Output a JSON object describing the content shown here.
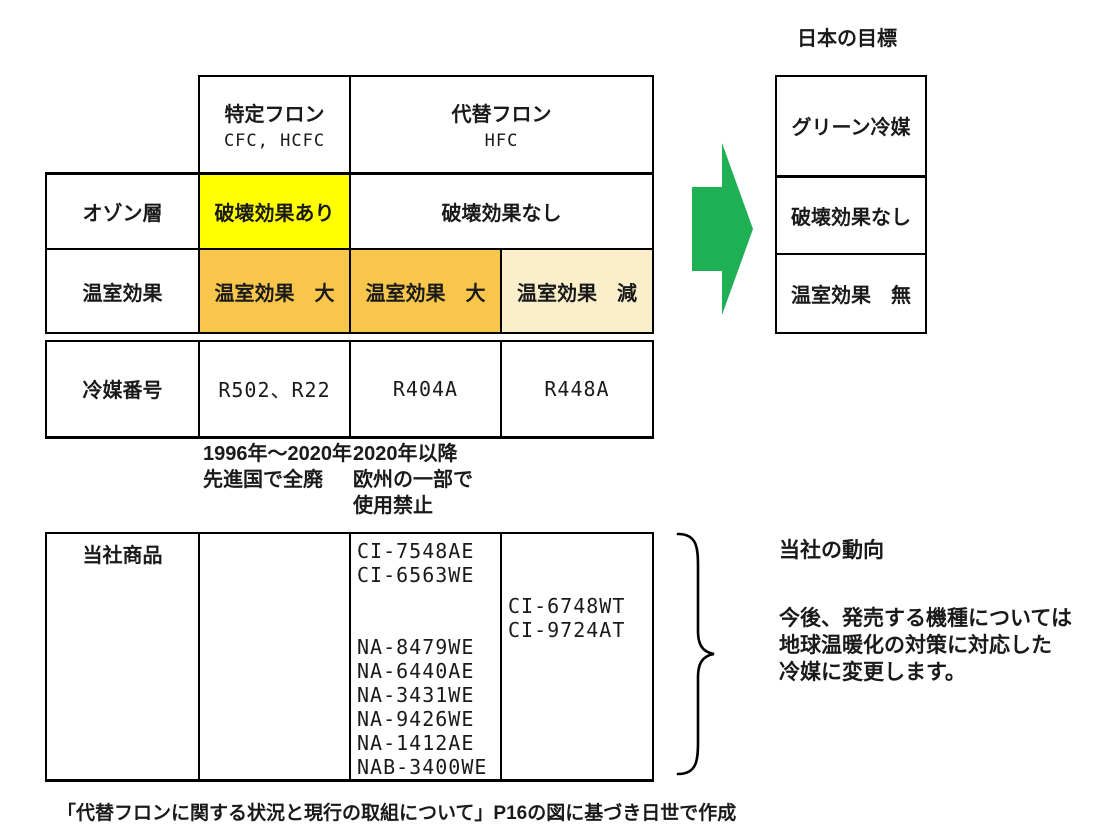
{
  "japan_goal": {
    "title": "日本の目標",
    "rows": [
      "グリーン冷媒",
      "破壊効果なし",
      "温室効果　無"
    ]
  },
  "comparison": {
    "col_specified": {
      "name": "特定フロン",
      "sub": "CFC, HCFC"
    },
    "col_alternative": {
      "name": "代替フロン",
      "sub": "HFC"
    },
    "row_ozone": {
      "label": "オゾン層",
      "specified": "破壊効果あり",
      "alternative": "破壊効果なし"
    },
    "row_greenhouse": {
      "label": "温室効果",
      "specified": "温室効果　大",
      "hfc_large": "温室効果　大",
      "hfc_reduced": "温室効果　減"
    }
  },
  "refrigerant_numbers": {
    "label": "冷媒番号",
    "cfc_hcfc": "R502、R22",
    "hfc_1": "R404A",
    "hfc_2": "R448A"
  },
  "phaseout_notes": {
    "cfc": [
      "1996年～2020年",
      "先進国で全廃"
    ],
    "hfc": [
      "2020年以降",
      "欧州の一部で",
      "使用禁止"
    ]
  },
  "products": {
    "label": "当社商品",
    "r404a_models": [
      "CI-7548AE",
      "CI-6563WE",
      "",
      "",
      "NA-8479WE",
      "NA-6440AE",
      "NA-3431WE",
      "NA-9426WE",
      "NA-1412AE",
      "NAB-3400WE"
    ],
    "r448a_models": [
      "CI-6748WT",
      "CI-9724AT"
    ]
  },
  "company_trend": {
    "title": "当社の動向",
    "body": [
      "今後、発売する機種については",
      "地球温暖化の対策に対応した",
      "冷媒に変更します。"
    ]
  },
  "caption": "「代替フロンに関する状況と現行の取組について」P16の図に基づき日世で作成",
  "colors": {
    "highlight_yellow": "#FFFF00",
    "highlight_amber": "#F7C64B",
    "highlight_cream": "#FBEECB",
    "arrow_green": "#1FAF54",
    "border_black": "#000000"
  }
}
